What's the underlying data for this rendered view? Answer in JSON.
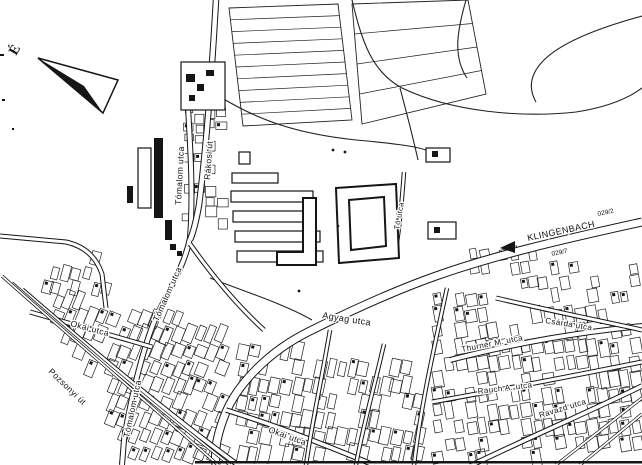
{
  "map": {
    "compass": {
      "label": "É"
    },
    "labels": [
      {
        "id": "tomalom-utca-north",
        "text": "Tómalom utca",
        "x": 181,
        "y": 205,
        "rot": -87,
        "size": 8.5
      },
      {
        "id": "rakosi-ut",
        "text": "Rákosi út",
        "x": 210,
        "y": 180,
        "rot": -86,
        "size": 8.5
      },
      {
        "id": "tomalom-utca-mid",
        "text": "Tómalom utca",
        "x": 158,
        "y": 322,
        "rot": -66,
        "size": 8.5
      },
      {
        "id": "tomalom-utca-south",
        "text": "Tómalom utca",
        "x": 129,
        "y": 438,
        "rot": -78,
        "size": 8.5
      },
      {
        "id": "pozsonyi-ut",
        "text": "Pozsonyi út",
        "x": 48,
        "y": 372,
        "rot": 44,
        "size": 8.5
      },
      {
        "id": "okai-utca-west",
        "text": "Okai utca",
        "x": 70,
        "y": 326,
        "rot": 15,
        "size": 8.5
      },
      {
        "id": "okai-utca-south",
        "text": "Okai utca",
        "x": 268,
        "y": 432,
        "rot": 20,
        "size": 8.5
      },
      {
        "id": "agyag-utca",
        "text": "Agyag utca",
        "x": 322,
        "y": 318,
        "rot": 9,
        "size": 9
      },
      {
        "id": "klingenbach",
        "text": "KLINGENBACH",
        "x": 528,
        "y": 241,
        "rot": -12,
        "size": 9,
        "ls": 1.4
      },
      {
        "id": "thurner-m-utca",
        "text": "Thurner M. utca",
        "x": 462,
        "y": 352,
        "rot": -11,
        "size": 8
      },
      {
        "id": "csarda-utca",
        "text": "Csárda utca",
        "x": 545,
        "y": 323,
        "rot": 9,
        "size": 8
      },
      {
        "id": "rauch-a-utca",
        "text": "Rauch A. utca",
        "x": 478,
        "y": 394,
        "rot": -7,
        "size": 8
      },
      {
        "id": "ravazd-utca",
        "text": "Ravazd utca",
        "x": 540,
        "y": 418,
        "rot": -17,
        "size": 8
      },
      {
        "id": "to-utca",
        "text": "Tó utca",
        "x": 399,
        "y": 230,
        "rot": -80,
        "size": 7.5
      }
    ],
    "parcel_numbers": [
      {
        "text": "029/2",
        "x": 598,
        "y": 216,
        "rot": -12
      },
      {
        "text": "029/7",
        "x": 552,
        "y": 256,
        "rot": -12
      }
    ]
  }
}
